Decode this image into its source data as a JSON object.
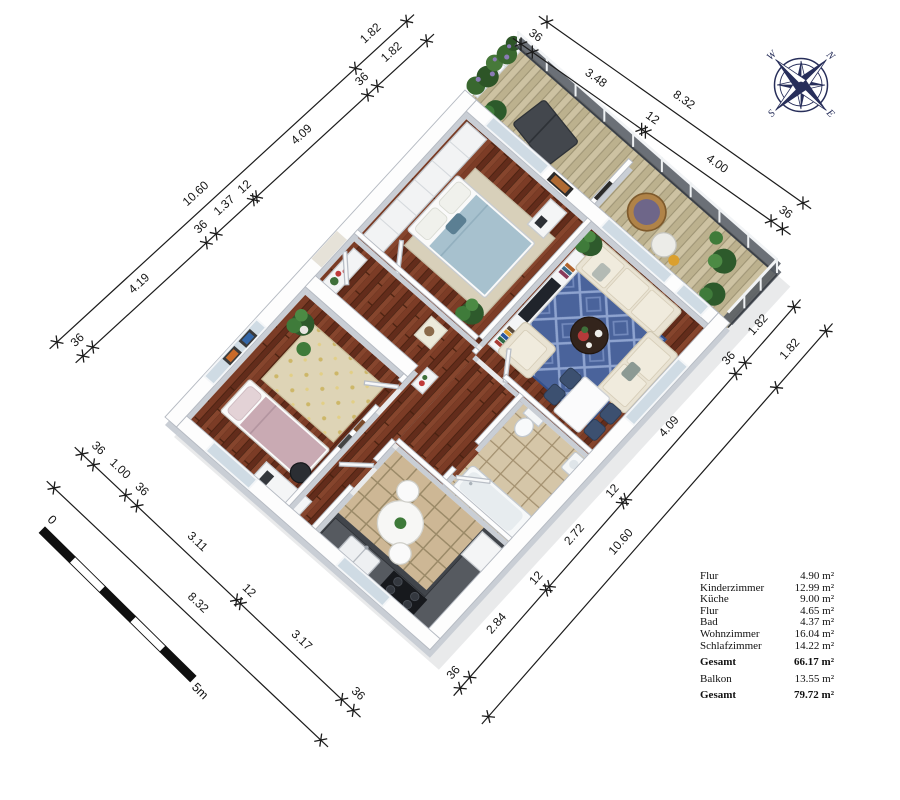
{
  "legend": {
    "rows": [
      {
        "label": "Flur",
        "value": "4.90 m²",
        "bold": false,
        "gap": false
      },
      {
        "label": "Kinderzimmer",
        "value": "12.99 m²",
        "bold": false,
        "gap": false
      },
      {
        "label": "Küche",
        "value": "9.00 m²",
        "bold": false,
        "gap": false
      },
      {
        "label": "Flur",
        "value": "4.65 m²",
        "bold": false,
        "gap": false
      },
      {
        "label": "Bad",
        "value": "4.37 m²",
        "bold": false,
        "gap": false
      },
      {
        "label": "Wohnzimmer",
        "value": "16.04 m²",
        "bold": false,
        "gap": false
      },
      {
        "label": "Schlafzimmer",
        "value": "14.22 m²",
        "bold": false,
        "gap": false
      },
      {
        "label": "Gesamt",
        "value": "66.17 m²",
        "bold": true,
        "gap": true
      },
      {
        "label": "Balkon",
        "value": "13.55 m²",
        "bold": false,
        "gap": true
      },
      {
        "label": "Gesamt",
        "value": "79.72 m²",
        "bold": true,
        "gap": true
      }
    ]
  },
  "compass": {
    "points": [
      {
        "label": "N"
      },
      {
        "label": "E"
      },
      {
        "label": "S"
      },
      {
        "label": "W"
      }
    ]
  },
  "scale_bar": {
    "start_label": "0",
    "end_label": "5m",
    "segments": 5
  },
  "dimensions": {
    "chains": [
      {
        "id": "left-outer",
        "segments": [
          {
            "label": "10.60",
            "m": 10.6
          },
          {
            "label": "1.82",
            "m": 1.82
          }
        ]
      },
      {
        "id": "left-inner",
        "segments": [
          {
            "label": "36",
            "m": 0.36
          },
          {
            "label": "4.19",
            "m": 4.19
          },
          {
            "label": "36",
            "m": 0.36
          },
          {
            "label": "1.37",
            "m": 1.37
          },
          {
            "label": "12",
            "m": 0.12
          },
          {
            "label": "4.09",
            "m": 4.09
          },
          {
            "label": "36",
            "m": 0.36
          },
          {
            "label": "1.82",
            "m": 1.82
          }
        ]
      },
      {
        "id": "top-outer",
        "segments": [
          {
            "label": "8.32",
            "m": 8.32
          }
        ]
      },
      {
        "id": "top-inner",
        "segments": [
          {
            "label": "36",
            "m": 0.36
          },
          {
            "label": "3.48",
            "m": 3.48
          },
          {
            "label": "12",
            "m": 0.12
          },
          {
            "label": "4.00",
            "m": 4.0
          },
          {
            "label": "36",
            "m": 0.36
          }
        ]
      },
      {
        "id": "right-outer",
        "segments": [
          {
            "label": "1.82",
            "m": 1.82
          },
          {
            "label": "10.60",
            "m": 10.6
          }
        ]
      },
      {
        "id": "right-inner",
        "segments": [
          {
            "label": "1.82",
            "m": 1.82
          },
          {
            "label": "36",
            "m": 0.36
          },
          {
            "label": "4.09",
            "m": 4.09
          },
          {
            "label": "12",
            "m": 0.12
          },
          {
            "label": "2.72",
            "m": 2.72
          },
          {
            "label": "12",
            "m": 0.12
          },
          {
            "label": "2.84",
            "m": 2.84
          },
          {
            "label": "36",
            "m": 0.36
          }
        ]
      },
      {
        "id": "bottom-outer",
        "segments": [
          {
            "label": "8.32",
            "m": 8.32
          }
        ]
      },
      {
        "id": "bottom-inner",
        "segments": [
          {
            "label": "36",
            "m": 0.36
          },
          {
            "label": "1.00",
            "m": 1.0
          },
          {
            "label": "36",
            "m": 0.36
          },
          {
            "label": "3.11",
            "m": 3.11
          },
          {
            "label": "12",
            "m": 0.12
          },
          {
            "label": "3.17",
            "m": 3.17
          },
          {
            "label": "36",
            "m": 0.36
          }
        ]
      }
    ]
  },
  "colors": {
    "dim_line": "#1b1b1b",
    "compass": "#272e5a",
    "wood": "#6e3320",
    "tile": "#cdb795",
    "deck": "#cbc09f",
    "rug_blue": "#4a639b",
    "wall_top": "#fdfdfd",
    "wall_side": "#c9ced5"
  }
}
